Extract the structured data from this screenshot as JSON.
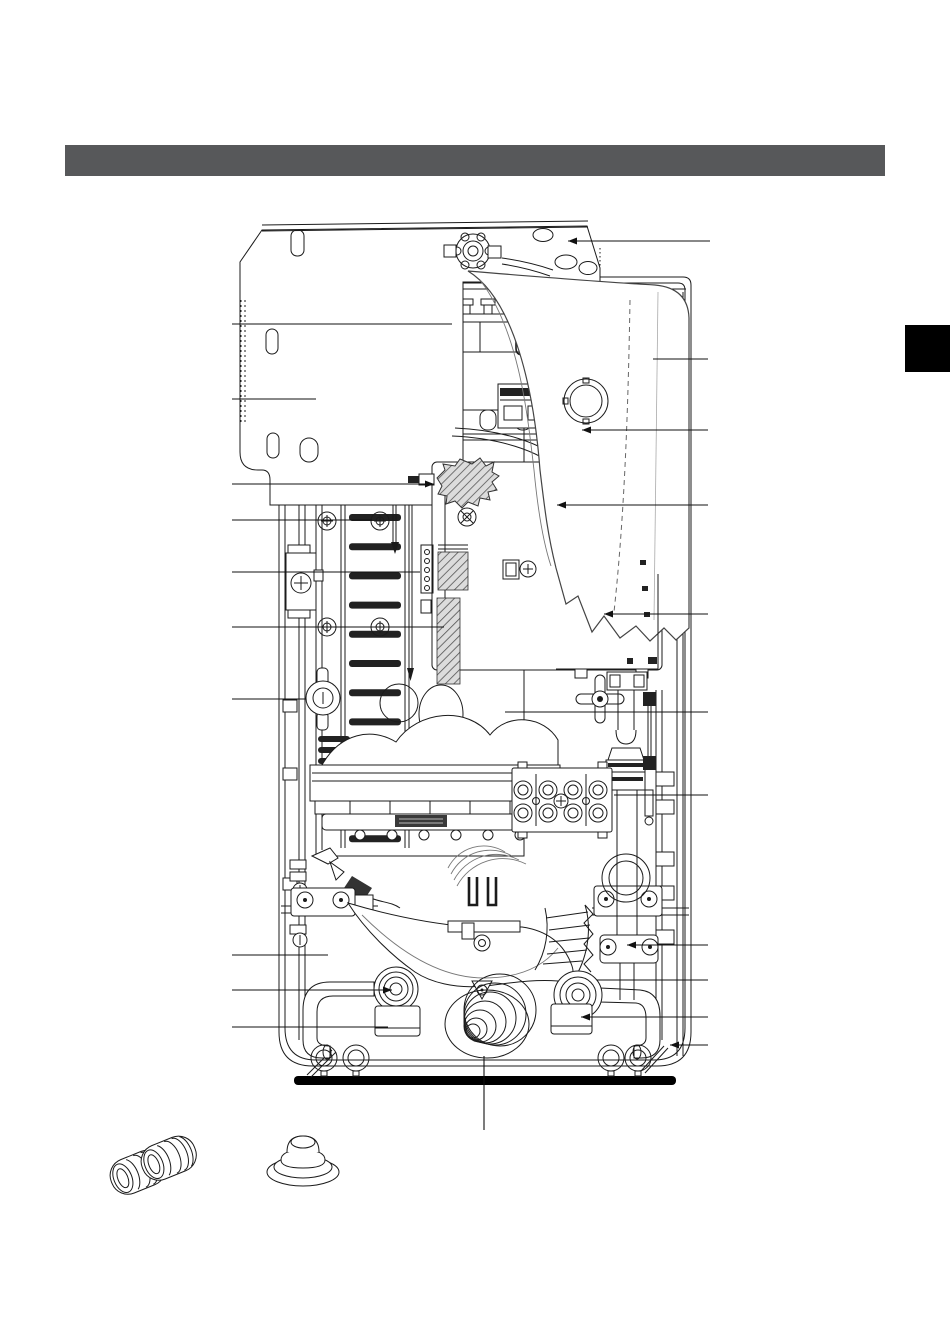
{
  "page": {
    "background": "#ffffff",
    "kind": "service-manual-parts-diagram-page"
  },
  "header": {
    "bar_color": "#57585a"
  },
  "edge_tab": {
    "color": "#000000"
  },
  "figure": {
    "type": "internal-parts-diagram",
    "subject": "wall-hung-water-heater-interior",
    "line_color": "#1b1b1b",
    "callouts": [
      {
        "id": "callout-l1",
        "side": "left",
        "y": 324,
        "x1": 232,
        "x2": 452,
        "arrow": null
      },
      {
        "id": "callout-l2",
        "side": "left",
        "y": 399,
        "x1": 232,
        "x2": 316,
        "arrow": null
      },
      {
        "id": "callout-l3",
        "side": "left",
        "y": 484,
        "x1": 232,
        "x2": 434,
        "arrow": "end"
      },
      {
        "id": "callout-l4",
        "side": "left",
        "y": 520,
        "x1": 232,
        "x2": 372,
        "arrow": null
      },
      {
        "id": "callout-l5",
        "side": "left",
        "y": 572,
        "x1": 232,
        "x2": 420,
        "arrow": null
      },
      {
        "id": "callout-l6",
        "side": "left",
        "y": 627,
        "x1": 232,
        "x2": 444,
        "arrow": null
      },
      {
        "id": "callout-l7",
        "side": "left",
        "y": 699,
        "x1": 232,
        "x2": 306,
        "arrow": null
      },
      {
        "id": "callout-l8",
        "side": "left",
        "y": 955,
        "x1": 232,
        "x2": 328,
        "arrow": null
      },
      {
        "id": "callout-l9",
        "side": "left",
        "y": 990,
        "x1": 232,
        "x2": 392,
        "arrow": "end"
      },
      {
        "id": "callout-l10",
        "side": "left",
        "y": 1027,
        "x1": 232,
        "x2": 388,
        "arrow": null
      },
      {
        "id": "callout-r1",
        "side": "right",
        "y": 241,
        "x1": 568,
        "x2": 710,
        "arrow": "start"
      },
      {
        "id": "callout-r2",
        "side": "right",
        "y": 359,
        "x1": 653,
        "x2": 708,
        "arrow": null
      },
      {
        "id": "callout-r3",
        "side": "right",
        "y": 430,
        "x1": 582,
        "x2": 708,
        "arrow": "start"
      },
      {
        "id": "callout-r4",
        "side": "right",
        "y": 505,
        "x1": 557,
        "x2": 708,
        "arrow": "start"
      },
      {
        "id": "callout-r5",
        "side": "right",
        "y": 614,
        "x1": 604,
        "x2": 708,
        "arrow": "start"
      },
      {
        "id": "callout-r6",
        "side": "right",
        "y": 712,
        "x1": 505,
        "x2": 708,
        "arrow": null
      },
      {
        "id": "callout-r7",
        "side": "right",
        "y": 795,
        "x1": 614,
        "x2": 708,
        "arrow": null
      },
      {
        "id": "callout-r8",
        "side": "right",
        "y": 945,
        "x1": 627,
        "x2": 708,
        "arrow": "start"
      },
      {
        "id": "callout-r9",
        "side": "right",
        "y": 980,
        "x1": 597,
        "x2": 708,
        "arrow": null
      },
      {
        "id": "callout-r10",
        "side": "right",
        "y": 1017,
        "x1": 581,
        "x2": 708,
        "arrow": "start"
      },
      {
        "id": "callout-r11",
        "side": "right",
        "y": 1045,
        "x1": 670,
        "x2": 708,
        "arrow": "start"
      },
      {
        "id": "callout-b1",
        "side": "bottom",
        "x": 484,
        "y1": 1056,
        "y2": 1130,
        "arrow": null
      }
    ],
    "inset_parts": [
      {
        "id": "ribbed-bushings",
        "count": 2
      },
      {
        "id": "cone-grommet",
        "count": 1
      }
    ]
  }
}
